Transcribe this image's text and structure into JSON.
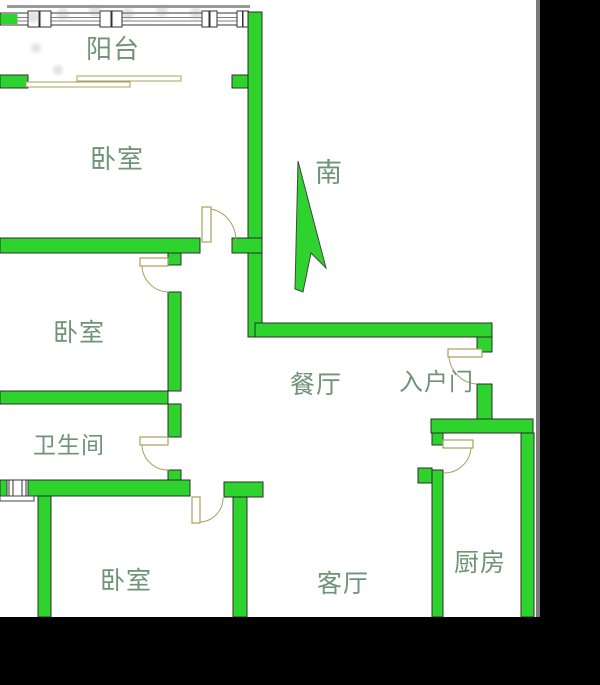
{
  "image": {
    "kind": "floor-plan-photo",
    "width": 600,
    "height": 685
  },
  "rooms": {
    "balcony": "阳台",
    "bedroom_top": "卧室",
    "bedroom_middle": "卧室",
    "bathroom": "卫生间",
    "bedroom_bottom": "卧室",
    "dining": "餐厅",
    "entry_door": "入户门",
    "living": "客厅",
    "kitchen": "厨房"
  },
  "compass": {
    "south": "南"
  },
  "colors": {
    "wall": "#2ed32e",
    "wall_edge": "#2d2d2d",
    "door_symbol": "#a9a05b",
    "label_text": "#6e9377",
    "mask": "#000000",
    "background": "#ffffff"
  }
}
